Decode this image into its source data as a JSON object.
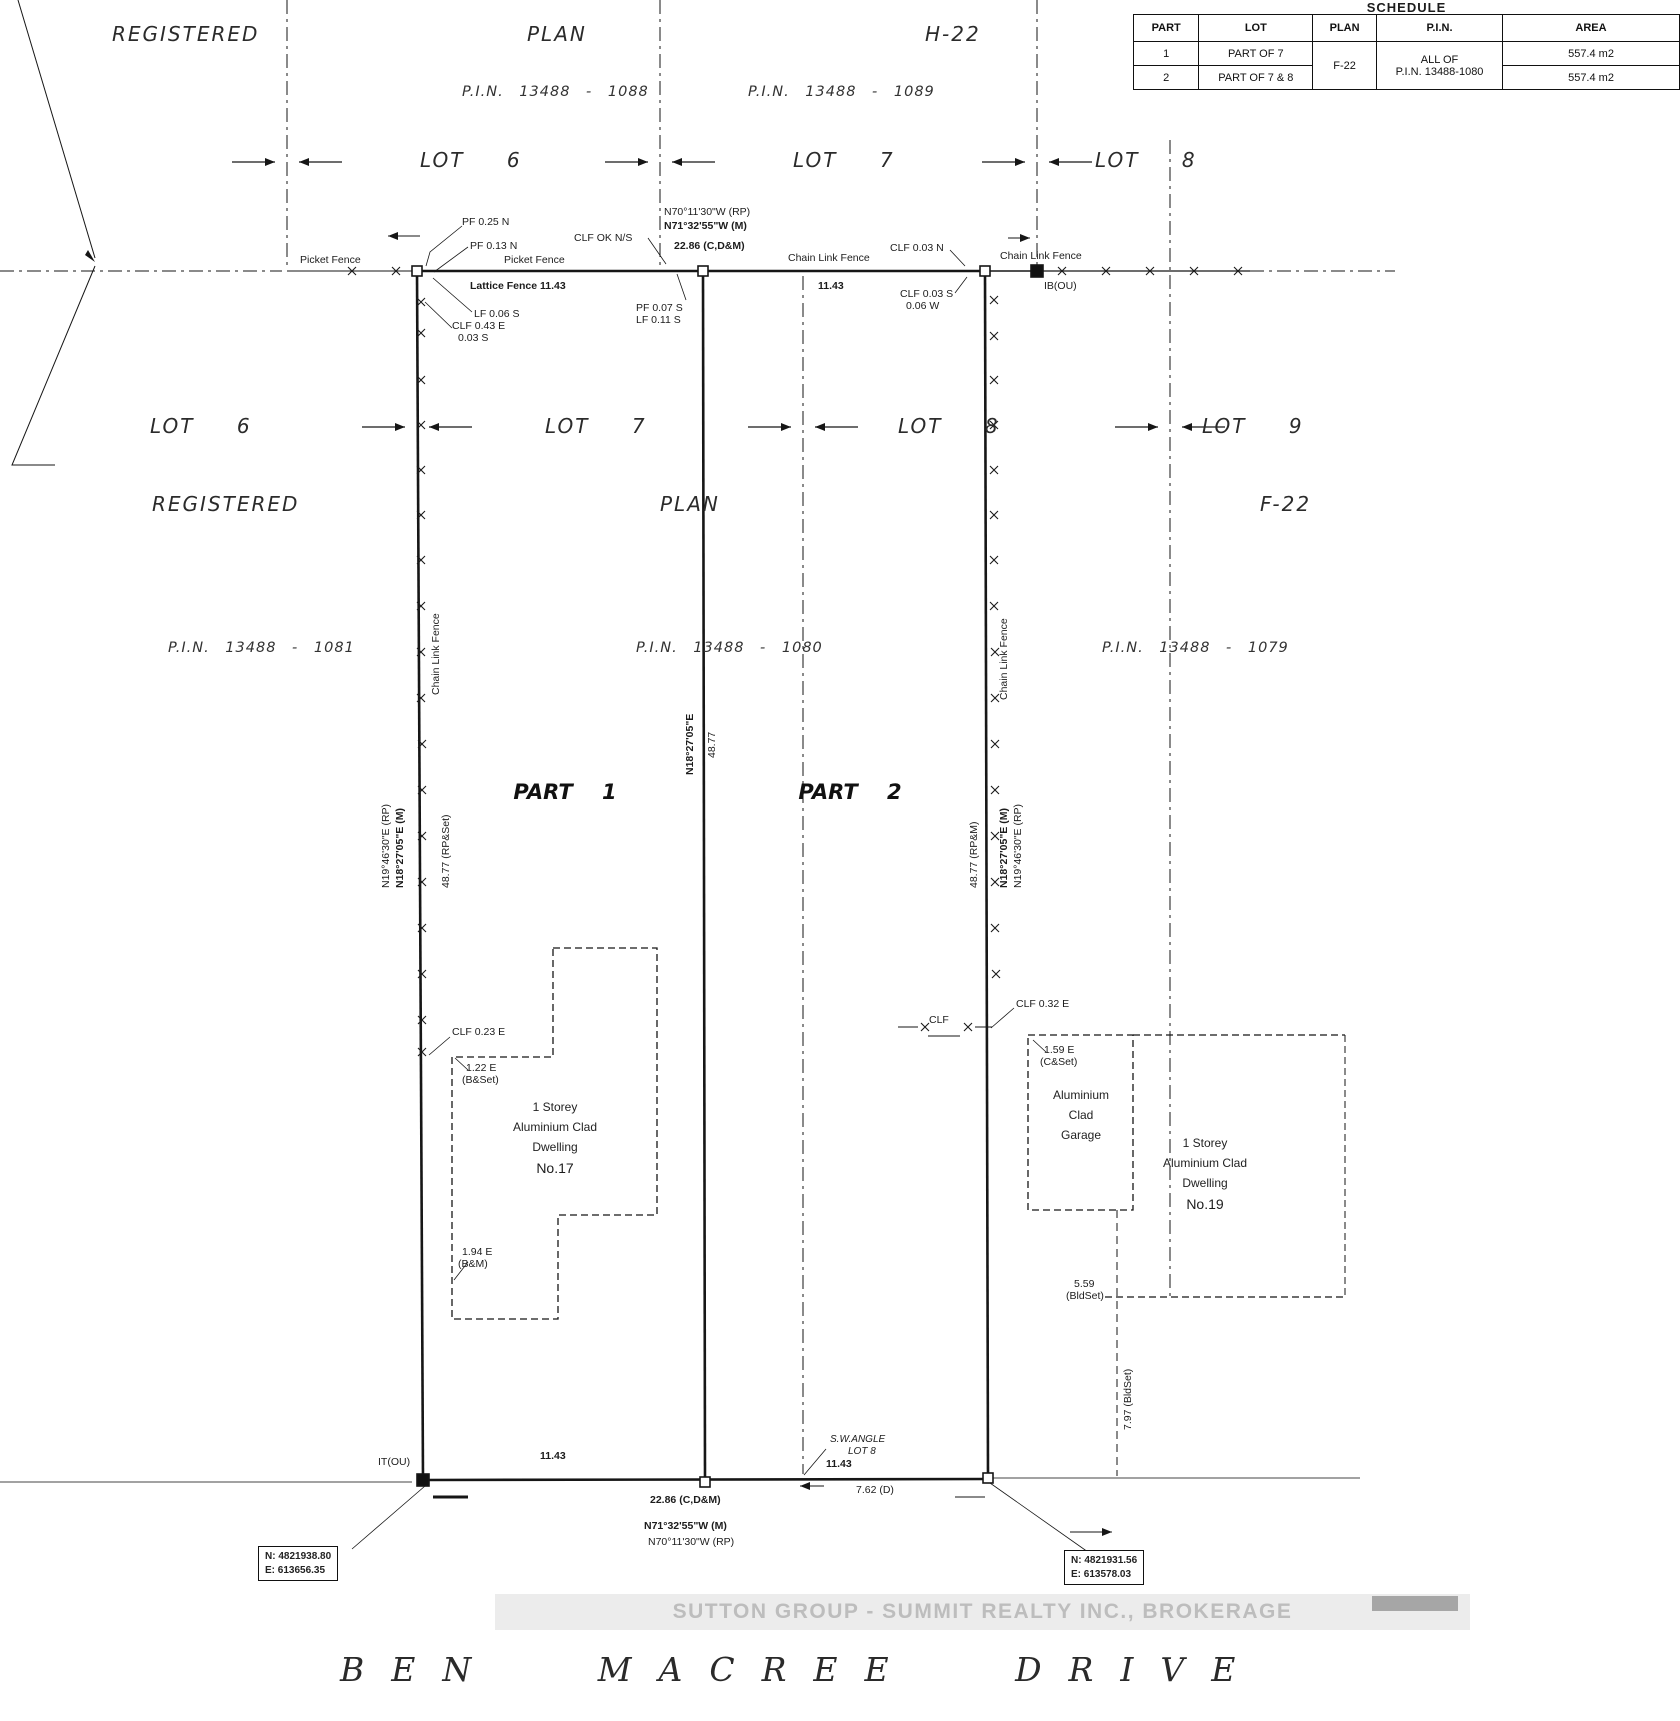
{
  "schedule": {
    "title": "SCHEDULE",
    "headers": [
      "PART",
      "LOT",
      "PLAN",
      "P.I.N.",
      "AREA"
    ],
    "plan_value": "F-22",
    "pin_line1": "ALL OF",
    "pin_line2": "P.I.N. 13488-1080",
    "rows": [
      {
        "part": "1",
        "lot": "PART OF 7",
        "area": "557.4 m2"
      },
      {
        "part": "2",
        "lot": "PART OF 7 & 8",
        "area": "557.4 m2"
      }
    ]
  },
  "top": {
    "registered": "REGISTERED",
    "plan": "PLAN",
    "h22": "H-22",
    "pin_1088": "P.I.N.  13488 - 1088",
    "pin_1089": "P.I.N.  13488 - 1089",
    "lot6": "LOT 6",
    "lot7": "LOT 7",
    "lot8": "LOT 8"
  },
  "fence_top": {
    "pf025": "PF 0.25 N",
    "pf013": "PF 0.13 N",
    "clf_ok": "CLF OK N/S",
    "picket_left": "Picket Fence",
    "picket_right": "Picket Fence",
    "lattice": "Lattice Fence  11.43",
    "lf006": "LF 0.06 S",
    "clf043": "CLF 0.43 E",
    "clf043b": "0.03 S",
    "pf007": "PF 0.07 S",
    "lf011": "LF 0.11 S",
    "brg_rp": "N70°11'30\"W  (RP)",
    "brg_m": "N71°32'55\"W (M)",
    "dist": "22.86 (C,D&M)",
    "clf_label": "Chain Link Fence",
    "d1143": "11.43",
    "clf003n": "CLF 0.03 N",
    "clf003s": "CLF 0.03 S",
    "w006": "0.06 W",
    "clf_label2": "Chain Link Fence",
    "ibou": "IB(OU)"
  },
  "mid": {
    "lot6": "LOT 6",
    "lot7": "LOT 7",
    "lot8": "LOT 8",
    "lot9": "LOT 9",
    "registered": "REGISTERED",
    "plan": "PLAN",
    "f22": "F-22",
    "pin_1081": "P.I.N.  13488 - 1081",
    "pin_1080": "P.I.N.  13488 - 1080",
    "pin_1079": "P.I.N.  13488 - 1079",
    "part1": "PART 1",
    "part2": "PART 2"
  },
  "west": {
    "clf": "Chain Link Fence",
    "brg_rp": "N19°46'30\"E  (RP)",
    "brg_m": "N18°27'05\"E (M)",
    "dist": "48.77 (RP&Set)"
  },
  "center_line": {
    "brg": "N18°27'05\"E",
    "dist": "48.77"
  },
  "east": {
    "clf": "Chain Link Fence",
    "dist": "48.77 (RP&M)",
    "brg_m": "N18°27'05\"E (M)",
    "brg_rp": "N19°46'30\"E  (RP)"
  },
  "bldg17": {
    "clf023": "CLF 0.23 E",
    "off122": "1.22 E",
    "off122b": "(B&Set)",
    "line1": "1 Storey",
    "line2": "Aluminium Clad",
    "line3": "Dwelling",
    "no": "No.17",
    "off194": "1.94 E",
    "off194b": "(B&M)"
  },
  "bldg19": {
    "clf032": "CLF 0.32 E",
    "clf_stub": "CLF",
    "off159": "1.59 E",
    "off159b": "(C&Set)",
    "g1": "Aluminium",
    "g2": "Clad",
    "g3": "Garage",
    "line1": "1 Storey",
    "line2": "Aluminium Clad",
    "line3": "Dwelling",
    "no": "No.19",
    "b559": "5.59",
    "b559b": "(BldSet)",
    "b797": "7.97 (BldSet)"
  },
  "bottom": {
    "itou": "IT(OU)",
    "d1143_left": "11.43",
    "dist": "22.86 (C,D&M)",
    "brg_m": "N71°32'55\"W (M)",
    "brg_rp": "N70°11'30\"W  (RP)",
    "sw_angle1": "S.W.ANGLE",
    "sw_angle2": "LOT 8",
    "d1143_right": "11.43",
    "d762": "7.62 (D)"
  },
  "coords": {
    "left_n": "N: 4821938.80",
    "left_e": "E: 613656.35",
    "right_n": "N: 4821931.56",
    "right_e": "E: 613578.03"
  },
  "watermark": "SUTTON GROUP - SUMMIT REALTY INC., BROKERAGE",
  "street": "BEN MACREE DRIVE"
}
